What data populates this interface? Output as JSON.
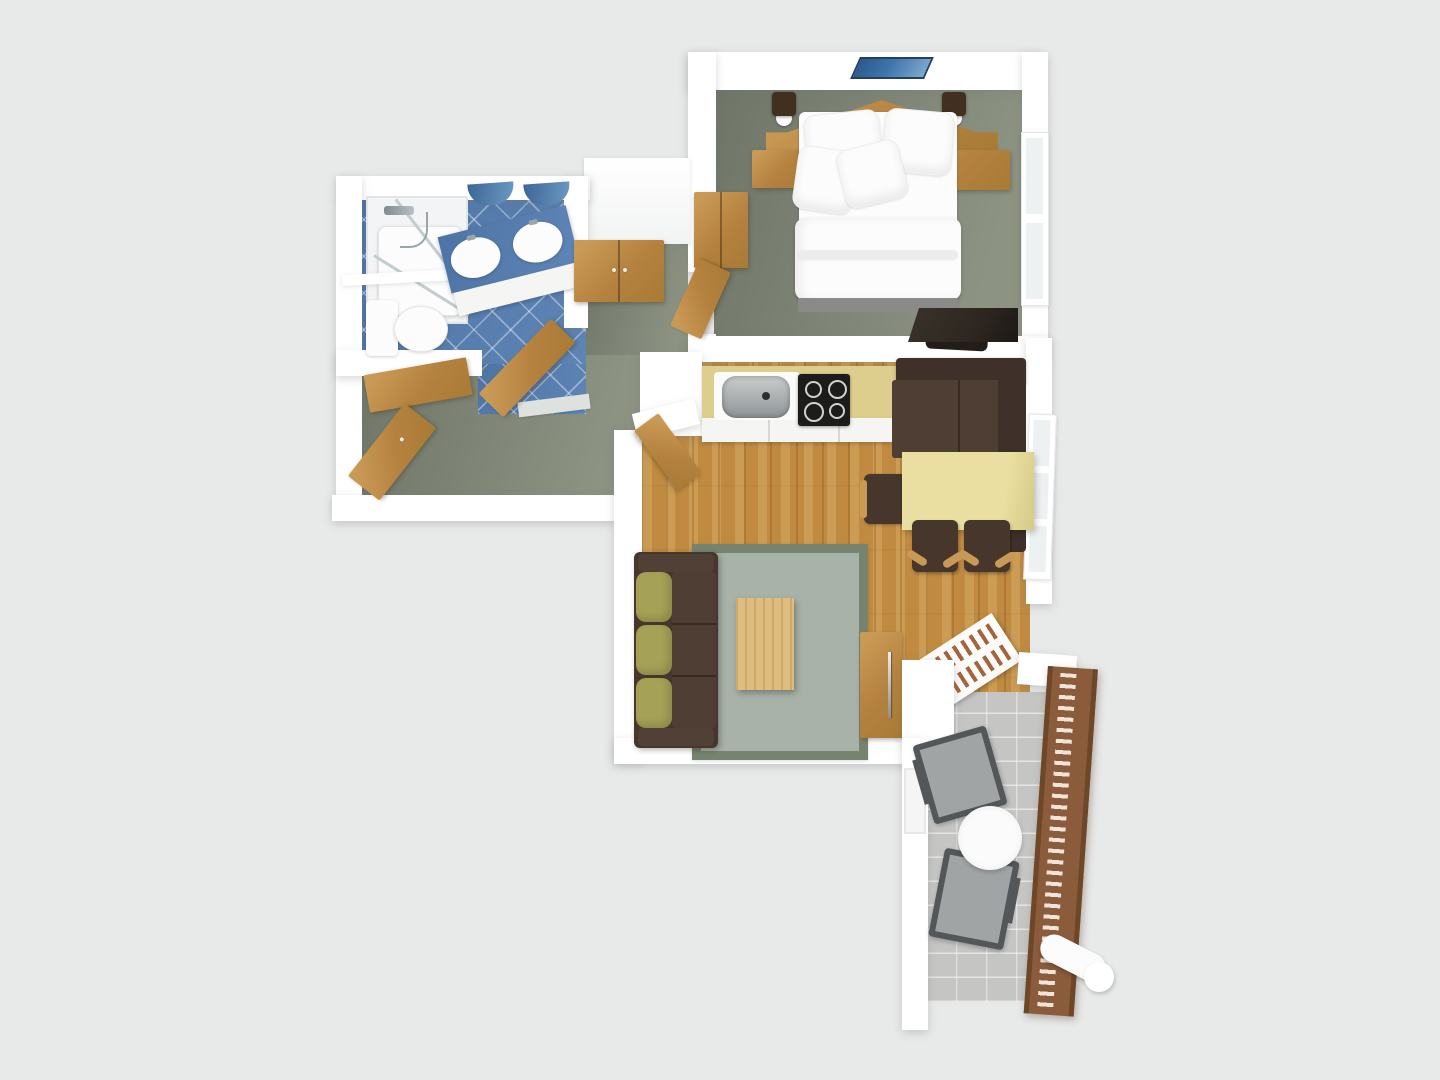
{
  "scene": {
    "type": "3d-floor-plan-render",
    "view": "top-down dollhouse",
    "rooms": [
      {
        "name": "bedroom",
        "floor": "green-grey carpet",
        "items": [
          "double-bed",
          "pillows",
          "peaked-headboard",
          "nightstand-left",
          "nightstand-right",
          "wall-lamp-left",
          "wall-lamp-right",
          "wall-picture",
          "wardrobe",
          "desk",
          "desk-chair",
          "window"
        ]
      },
      {
        "name": "bathroom",
        "floor": "blue diagonal tile",
        "items": [
          "shower-enclosure",
          "shower-fixture",
          "toilet",
          "vanity-double-sink",
          "mirror-left",
          "mirror-right",
          "bathroom-door"
        ]
      },
      {
        "name": "hallway",
        "floor": "green-grey carpet",
        "items": [
          "hall-wardrobe",
          "entrance-door",
          "flat-open-door",
          "door-to-living-room"
        ]
      },
      {
        "name": "kitchen-living-room",
        "floor": "oak plank wood",
        "items": [
          "kitchen-counter",
          "kitchen-sink",
          "cooktop",
          "corner-bench",
          "dining-table",
          "dining-chair-1",
          "dining-chair-2",
          "dining-chair-3",
          "sofa",
          "rug",
          "coffee-table",
          "sideboard",
          "drying-rack",
          "window-dining"
        ]
      },
      {
        "name": "balcony",
        "floor": "grey stone tile",
        "items": [
          "wood-railing",
          "folding-chair-1",
          "folding-chair-2",
          "round-table",
          "rolled-mat",
          "balcony-door"
        ]
      }
    ]
  },
  "palette": {
    "background": "#e8e9e9",
    "wall": "#ffffff",
    "wall_shade": "#f3f4f4",
    "wall_edge": "#dcdedd",
    "carpet_dark": "#6f7567",
    "carpet_light": "#8d9383",
    "tile_blue": "#4d74a4",
    "tile_blue_light": "#5e85b5",
    "wood": "#b5823f",
    "wood_light": "#c99a55",
    "wood_dark": "#a87b35",
    "oak_floor": "#c08b41",
    "counter_yellow": "#ddce8e",
    "table_yellow": "#eadfa0",
    "cabinet_white": "#f5f5f3",
    "cooktop": "#1c1c1b",
    "steel_light": "#c9cdce",
    "steel_dark": "#8f9496",
    "brown_dark": "#46362c",
    "brown_mid": "#4e3e33",
    "brown_back": "#3f3129",
    "olive": "#a5a257",
    "rug_center": "#a9b2a8",
    "rug_border": "#76846f",
    "balcony_floor": "#c5c6c4",
    "railing": "#8a5c3b",
    "railing_dark": "#6e4729",
    "chair_grey": "#a0a4a4",
    "chair_frame": "#54575a",
    "bed_white": "#fcfcfc",
    "bed_base": "#8a8a88",
    "picture_blue": "#3f74ab",
    "lamp_dark": "#41301f",
    "glass": "#eef1f2",
    "desk_dark": "#2e2721"
  }
}
